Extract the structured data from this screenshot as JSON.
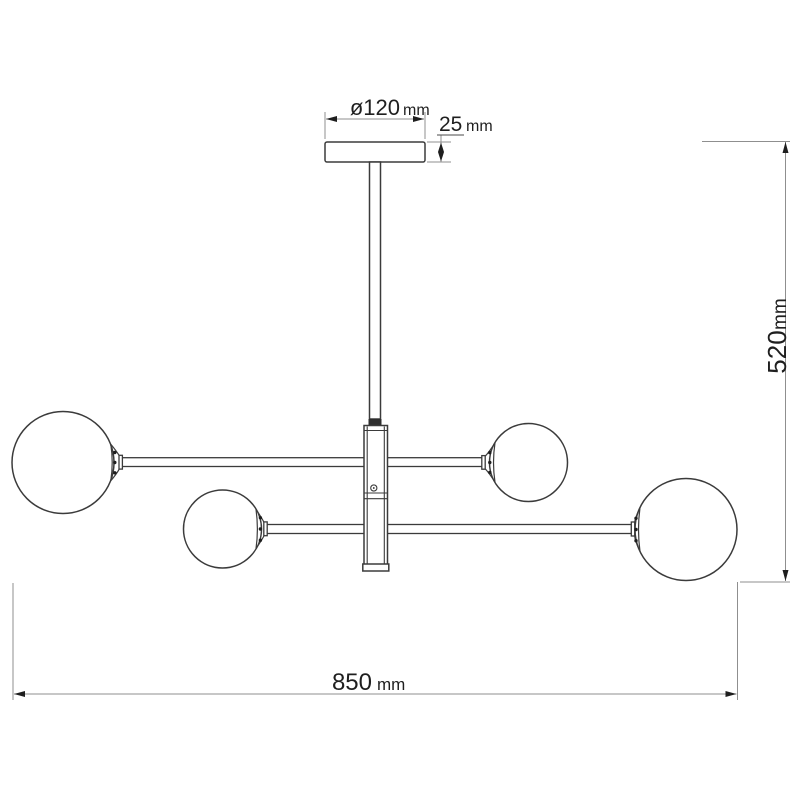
{
  "drawing": {
    "kind": "dimension-drawing",
    "background": "#ffffff",
    "line_color": "#3b3b3b",
    "dimension_line_color": "#8f8f8f",
    "text_color": "#1f1f1f"
  },
  "dimensions": {
    "canopy_diameter": {
      "value": "ø120",
      "unit": "mm"
    },
    "canopy_height": {
      "value": "25",
      "unit": "mm"
    },
    "overall_height": {
      "value": "520",
      "unit": "mm"
    },
    "overall_width": {
      "value": "850",
      "unit": "mm"
    }
  }
}
